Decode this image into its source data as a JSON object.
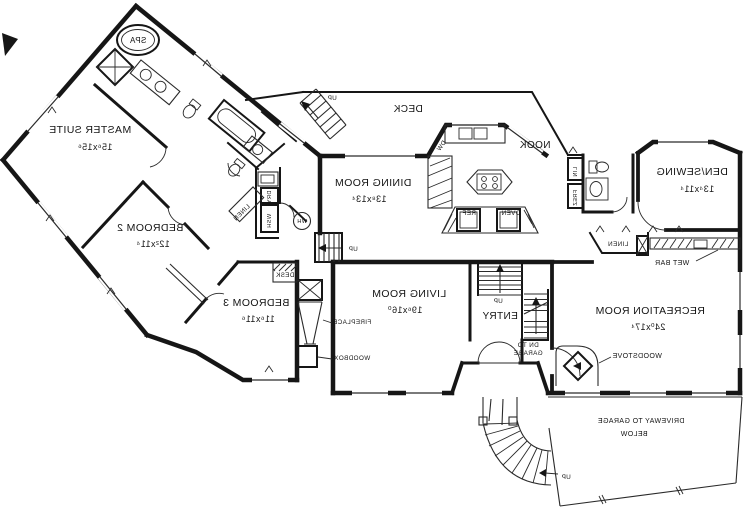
{
  "colors": {
    "ink": "#161616",
    "paper": "#ffffff"
  },
  "rooms": [
    {
      "name": "MASTER SUITE",
      "dims": "15⁶x15⁶"
    },
    {
      "name": "BEDROOM 2",
      "dims": "12²x11⁴"
    },
    {
      "name": "BEDROOM 3",
      "dims": "11⁶x11⁶"
    },
    {
      "name": "DINING ROOM",
      "dims": "13⁸x13⁴"
    },
    {
      "name": "LIVING ROOM",
      "dims": "19⁶x16⁰"
    },
    {
      "name": "RECREATION ROOM",
      "dims": "24⁰x17⁴"
    },
    {
      "name": "DEN/SEWING",
      "dims": "13⁴x11⁴"
    }
  ],
  "areas": {
    "deck": "DECK",
    "nook": "NOOK",
    "entry": "ENTRY",
    "spa": "SPA",
    "driveway_line1": "DRIVEWAY TO GARAGE",
    "driveway_line2": "BELOW"
  },
  "features": {
    "wet_bar": "WET BAR",
    "woodstove": "WOODSTOVE",
    "fireplace": "FIREPLACE",
    "woodbox": "WOODBOX",
    "desk": "DESK",
    "linen_hall": "LINEN",
    "linen_bar": "LINEN",
    "lin_closet": "LIN",
    "freezer": "FREZ"
  },
  "appliances": {
    "washer": "WSH",
    "dryer": "DRY",
    "water_heater": "WH",
    "dishwasher": "DW",
    "refrigerator": "REF",
    "oven": "OVEN"
  },
  "stairs": {
    "deck_up": "UP",
    "hall_up": "UP",
    "entry_up": "UP",
    "drive_up": "UP",
    "dn_line1": "DN TO",
    "dn_line2": "GARAGE"
  }
}
